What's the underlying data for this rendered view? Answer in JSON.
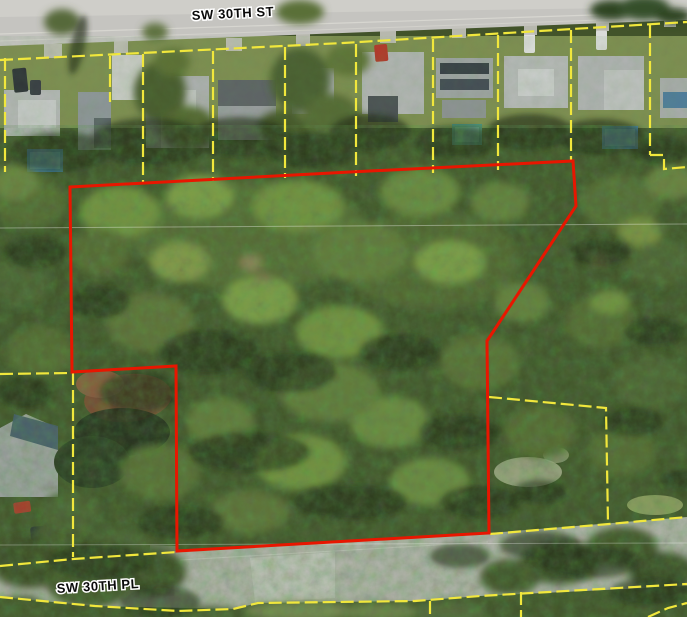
{
  "map": {
    "view": "aerial-parcel-view",
    "streets": {
      "top": {
        "label": "SW 30TH ST"
      },
      "bottom": {
        "label": "SW 30TH PL"
      }
    },
    "colors": {
      "parcel_line": "#f1e73c",
      "highlight_outline": "#e81600",
      "street_label": "#0a0a0a",
      "street_label_halo": "#ffffff"
    },
    "highlight_parcel": {
      "points": "70,187 350,172 573,161 576,206 487,341 489,533 177,551 176,366 72,372"
    },
    "parcel_lines": [
      "0,60 343,43 687,22",
      "5,58 5,172",
      "110,56 110,102",
      "143,54 143,184",
      "213,51 213,181",
      "285,47 285,178",
      "356,44 356,176",
      "433,39 433,173",
      "498,35 498,170",
      "571,30 571,161",
      "650,25 650,155",
      "650,155 664,155 664,169 687,167",
      "0,374 73,373 73,557",
      "0,566 73,559 177,552",
      "490,534 609,524 687,517",
      "489,397 606,408 608,523",
      "0,597 95,606 178,611 233,609 258,603 415,601 480,596 687,584",
      "430,601 430,617",
      "521,592 521,617",
      "648,617 668,608 687,603"
    ]
  }
}
